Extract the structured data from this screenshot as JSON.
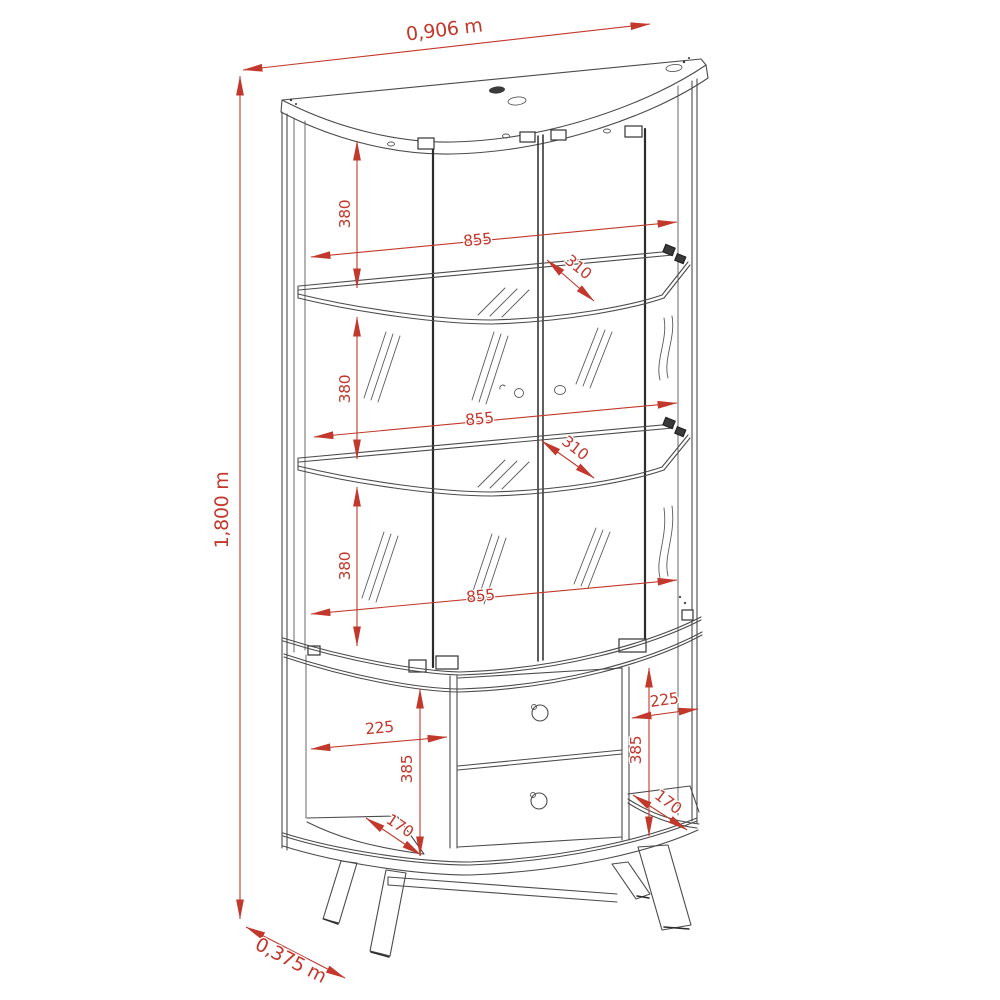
{
  "diagram": {
    "title": "Display cabinet technical line drawing with dimensions",
    "type": "furniture-dimension-drawing",
    "subject": "Curved-front display cabinet with glass doors, two glass shelves, two drawers and splayed legs",
    "background_color": "#ffffff",
    "line_color": "#4b4b4b",
    "dimension_color": "#c2382c",
    "units_overall": "m",
    "units_internal": "mm"
  },
  "dims": {
    "overall_width": "0,906 m",
    "overall_height": "1,800 m",
    "overall_depth": "0,375 m",
    "section_heights": [
      "380",
      "380",
      "380"
    ],
    "inner_widths": [
      "855",
      "855",
      "855"
    ],
    "shelf_depths": [
      "310",
      "310"
    ],
    "niche_widths": [
      "225",
      "225"
    ],
    "lower_heights": [
      "385",
      "385"
    ],
    "niche_depths": [
      "170",
      "170"
    ]
  }
}
